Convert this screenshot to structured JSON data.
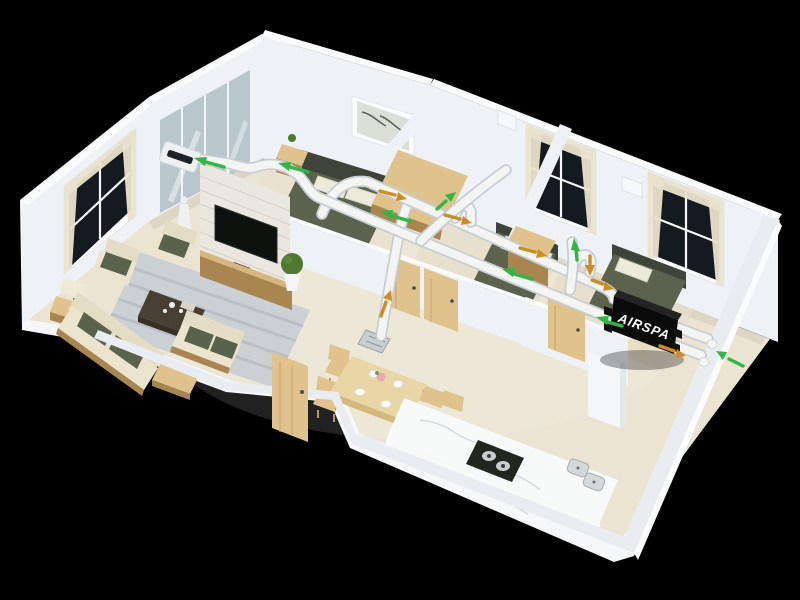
{
  "scene": {
    "unit": {
      "brand": "AIRSPA"
    },
    "airflow": {
      "supply_arrow_count": 8,
      "exhaust_arrow_count": 7
    },
    "colors": {
      "background": "#000000",
      "wall": "#eef1f5",
      "wall_top": "#fafbfc",
      "floor": "#ebe4d2",
      "rug": "#cbd0d4",
      "duct": "#f4f5f3",
      "duct_shadow": "#c7cdd4",
      "supply": "#2db843",
      "exhaust": "#cf8d1e",
      "unit": "#0b0b0b",
      "glass": "#b9c7cc",
      "marble": "#f8f9f9",
      "wood": "#dfc28c",
      "wood_dark": "#a9854f",
      "sofa": "#ece4ce",
      "cushion": "#59624b",
      "bed": "#5b624d",
      "curtain": "#e9e1cc",
      "window": "#141a20",
      "tv": "#0d120e",
      "plant": "#4c7a30"
    }
  }
}
